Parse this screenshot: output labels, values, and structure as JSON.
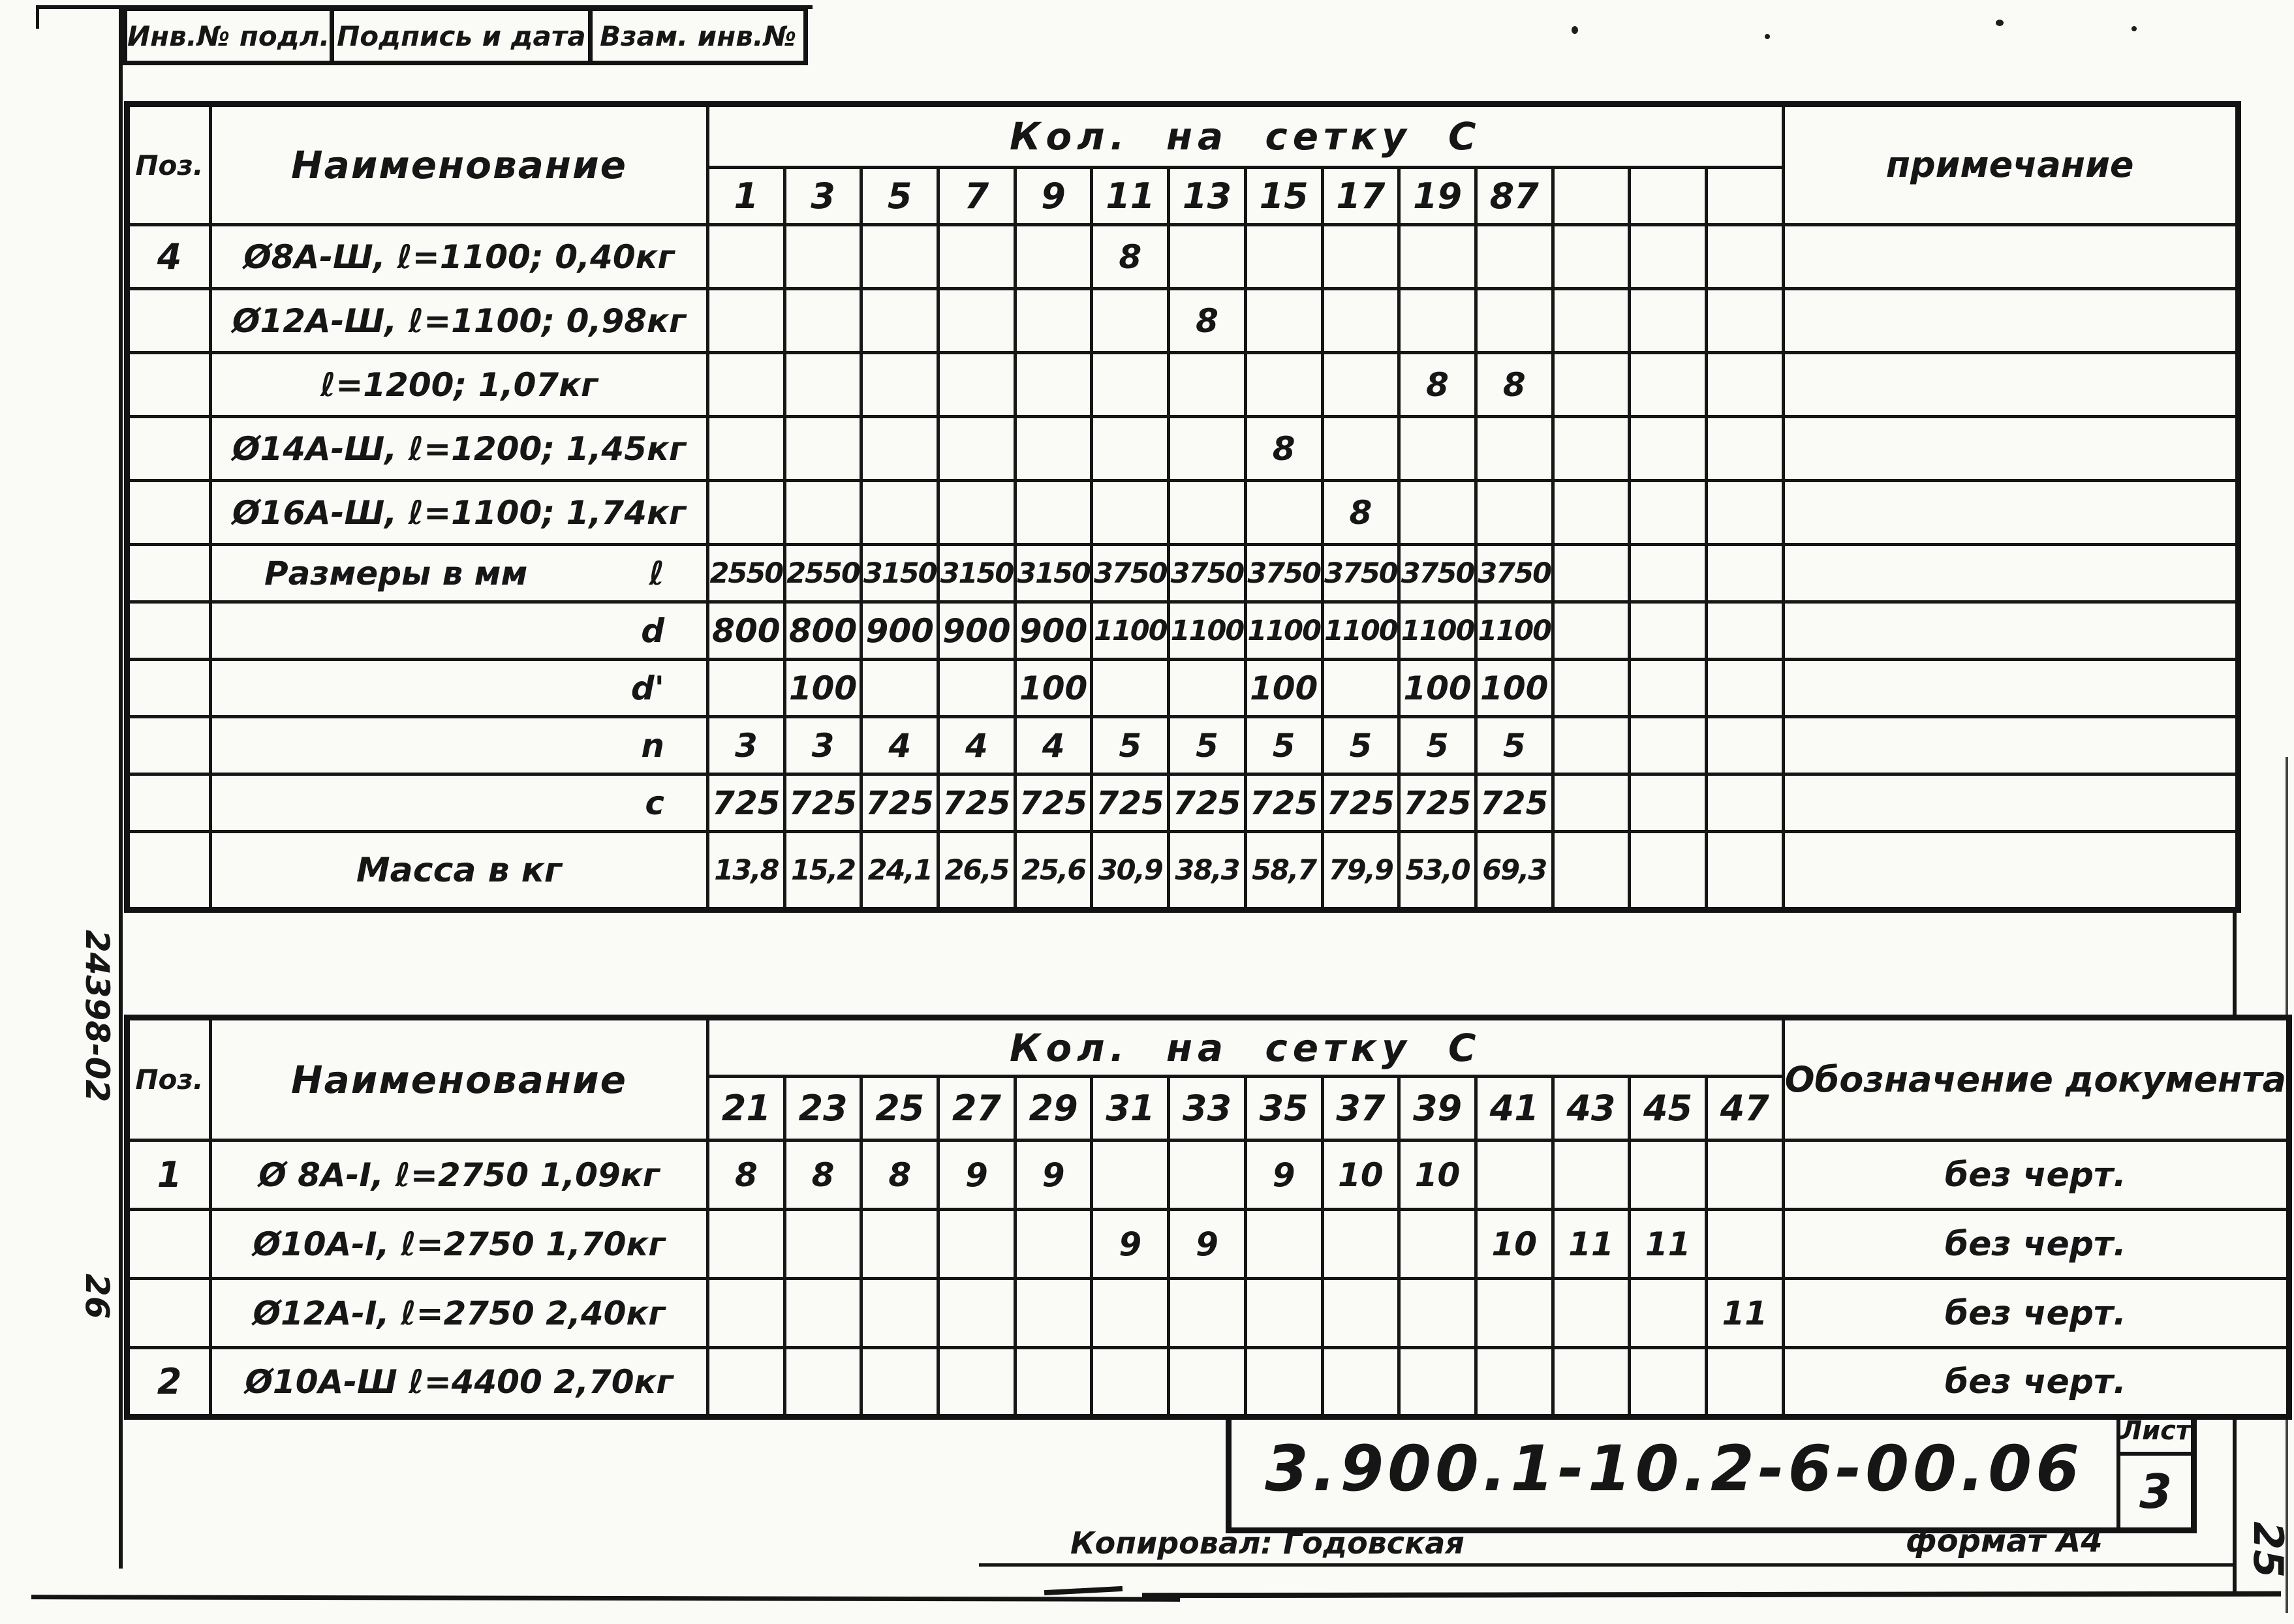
{
  "page": {
    "left_margin_code": "24398-02",
    "left_margin_code_2": "26",
    "right_margin_sheet_number": "25"
  },
  "top_strip": {
    "cells": [
      "Инв.№ подл.",
      "Подпись и дата",
      "Взам. инв.№"
    ]
  },
  "table1": {
    "pos_header": "Поз.",
    "name_header": "Наименование",
    "qty_header": "Кол. на сетку С",
    "note_header": "примечание",
    "columns": [
      "1",
      "3",
      "5",
      "7",
      "9",
      "11",
      "13",
      "15",
      "17",
      "19",
      "87",
      "",
      "",
      ""
    ],
    "rows": [
      {
        "pos": "4",
        "name": "Ø8А-Ш, ℓ=1100; 0,40кг",
        "values": [
          "",
          "",
          "",
          "",
          "",
          "8",
          "",
          "",
          "",
          "",
          "",
          "",
          "",
          ""
        ],
        "note": ""
      },
      {
        "pos": "",
        "name": "Ø12А-Ш, ℓ=1100; 0,98кг",
        "values": [
          "",
          "",
          "",
          "",
          "",
          "",
          "8",
          "",
          "",
          "",
          "",
          "",
          "",
          ""
        ],
        "note": ""
      },
      {
        "pos": "",
        "name": "ℓ=1200; 1,07кг",
        "values": [
          "",
          "",
          "",
          "",
          "",
          "",
          "",
          "",
          "",
          "8",
          "8",
          "",
          "",
          ""
        ],
        "note": ""
      },
      {
        "pos": "",
        "name": "Ø14А-Ш, ℓ=1200; 1,45кг",
        "values": [
          "",
          "",
          "",
          "",
          "",
          "",
          "",
          "8",
          "",
          "",
          "",
          "",
          "",
          ""
        ],
        "note": ""
      },
      {
        "pos": "",
        "name": "Ø16А-Ш, ℓ=1100; 1,74кг",
        "values": [
          "",
          "",
          "",
          "",
          "",
          "",
          "",
          "",
          "8",
          "",
          "",
          "",
          "",
          ""
        ],
        "note": ""
      },
      {
        "pos": "",
        "name": "Размеры в мм",
        "symbol": "ℓ",
        "values": [
          "2550",
          "2550",
          "3150",
          "3150",
          "3150",
          "3750",
          "3750",
          "3750",
          "3750",
          "3750",
          "3750",
          "",
          "",
          ""
        ],
        "note": ""
      },
      {
        "pos": "",
        "name": "",
        "symbol": "d",
        "values": [
          "800",
          "800",
          "900",
          "900",
          "900",
          "1100",
          "1100",
          "1100",
          "1100",
          "1100",
          "1100",
          "",
          "",
          ""
        ],
        "note": ""
      },
      {
        "pos": "",
        "name": "",
        "symbol": "d'",
        "values": [
          "",
          "100",
          "",
          "",
          "100",
          "",
          "",
          "100",
          "",
          "100",
          "100",
          "",
          "",
          ""
        ],
        "note": ""
      },
      {
        "pos": "",
        "name": "",
        "symbol": "n",
        "values": [
          "3",
          "3",
          "4",
          "4",
          "4",
          "5",
          "5",
          "5",
          "5",
          "5",
          "5",
          "",
          "",
          ""
        ],
        "note": ""
      },
      {
        "pos": "",
        "name": "",
        "symbol": "c",
        "values": [
          "725",
          "725",
          "725",
          "725",
          "725",
          "725",
          "725",
          "725",
          "725",
          "725",
          "725",
          "",
          "",
          ""
        ],
        "note": ""
      },
      {
        "pos": "",
        "name": "Масса в кг",
        "values": [
          "13,8",
          "15,2",
          "24,1",
          "26,5",
          "25,6",
          "30,9",
          "38,3",
          "58,7",
          "79,9",
          "53,0",
          "69,3",
          "",
          "",
          ""
        ],
        "note": ""
      }
    ]
  },
  "table2": {
    "pos_header": "Поз.",
    "name_header": "Наименование",
    "qty_header": "Кол. на сетку С",
    "note_header": "Обозначение\nдокумента",
    "columns": [
      "21",
      "23",
      "25",
      "27",
      "29",
      "31",
      "33",
      "35",
      "37",
      "39",
      "41",
      "43",
      "45",
      "47"
    ],
    "rows": [
      {
        "pos": "1",
        "name": "Ø 8А-I, ℓ=2750  1,09кг",
        "values": [
          "8",
          "8",
          "8",
          "9",
          "9",
          "",
          "",
          "9",
          "10",
          "10",
          "",
          "",
          "",
          ""
        ],
        "note": "без черт."
      },
      {
        "pos": "",
        "name": "Ø10А-I,  ℓ=2750  1,70кг",
        "values": [
          "",
          "",
          "",
          "",
          "",
          "9",
          "9",
          "",
          "",
          "",
          "10",
          "11",
          "11",
          ""
        ],
        "note": "без черт."
      },
      {
        "pos": "",
        "name": "Ø12А-I,  ℓ=2750  2,40кг",
        "values": [
          "",
          "",
          "",
          "",
          "",
          "",
          "",
          "",
          "",
          "",
          "",
          "",
          "",
          "11"
        ],
        "note": "без черт."
      },
      {
        "pos": "2",
        "name": "Ø10А-Ш  ℓ=4400 2,70кг",
        "values": [
          "",
          "",
          "",
          "",
          "",
          "",
          "",
          "",
          "",
          "",
          "",
          "",
          "",
          ""
        ],
        "note": "без черт."
      }
    ]
  },
  "title_block": {
    "doc_number": "3.900.1-10.2-6-00.06",
    "sheet_label": "Лист",
    "sheet_number": "3",
    "copied_by": "Копировал: Годовская",
    "format_label": "формат А4"
  }
}
